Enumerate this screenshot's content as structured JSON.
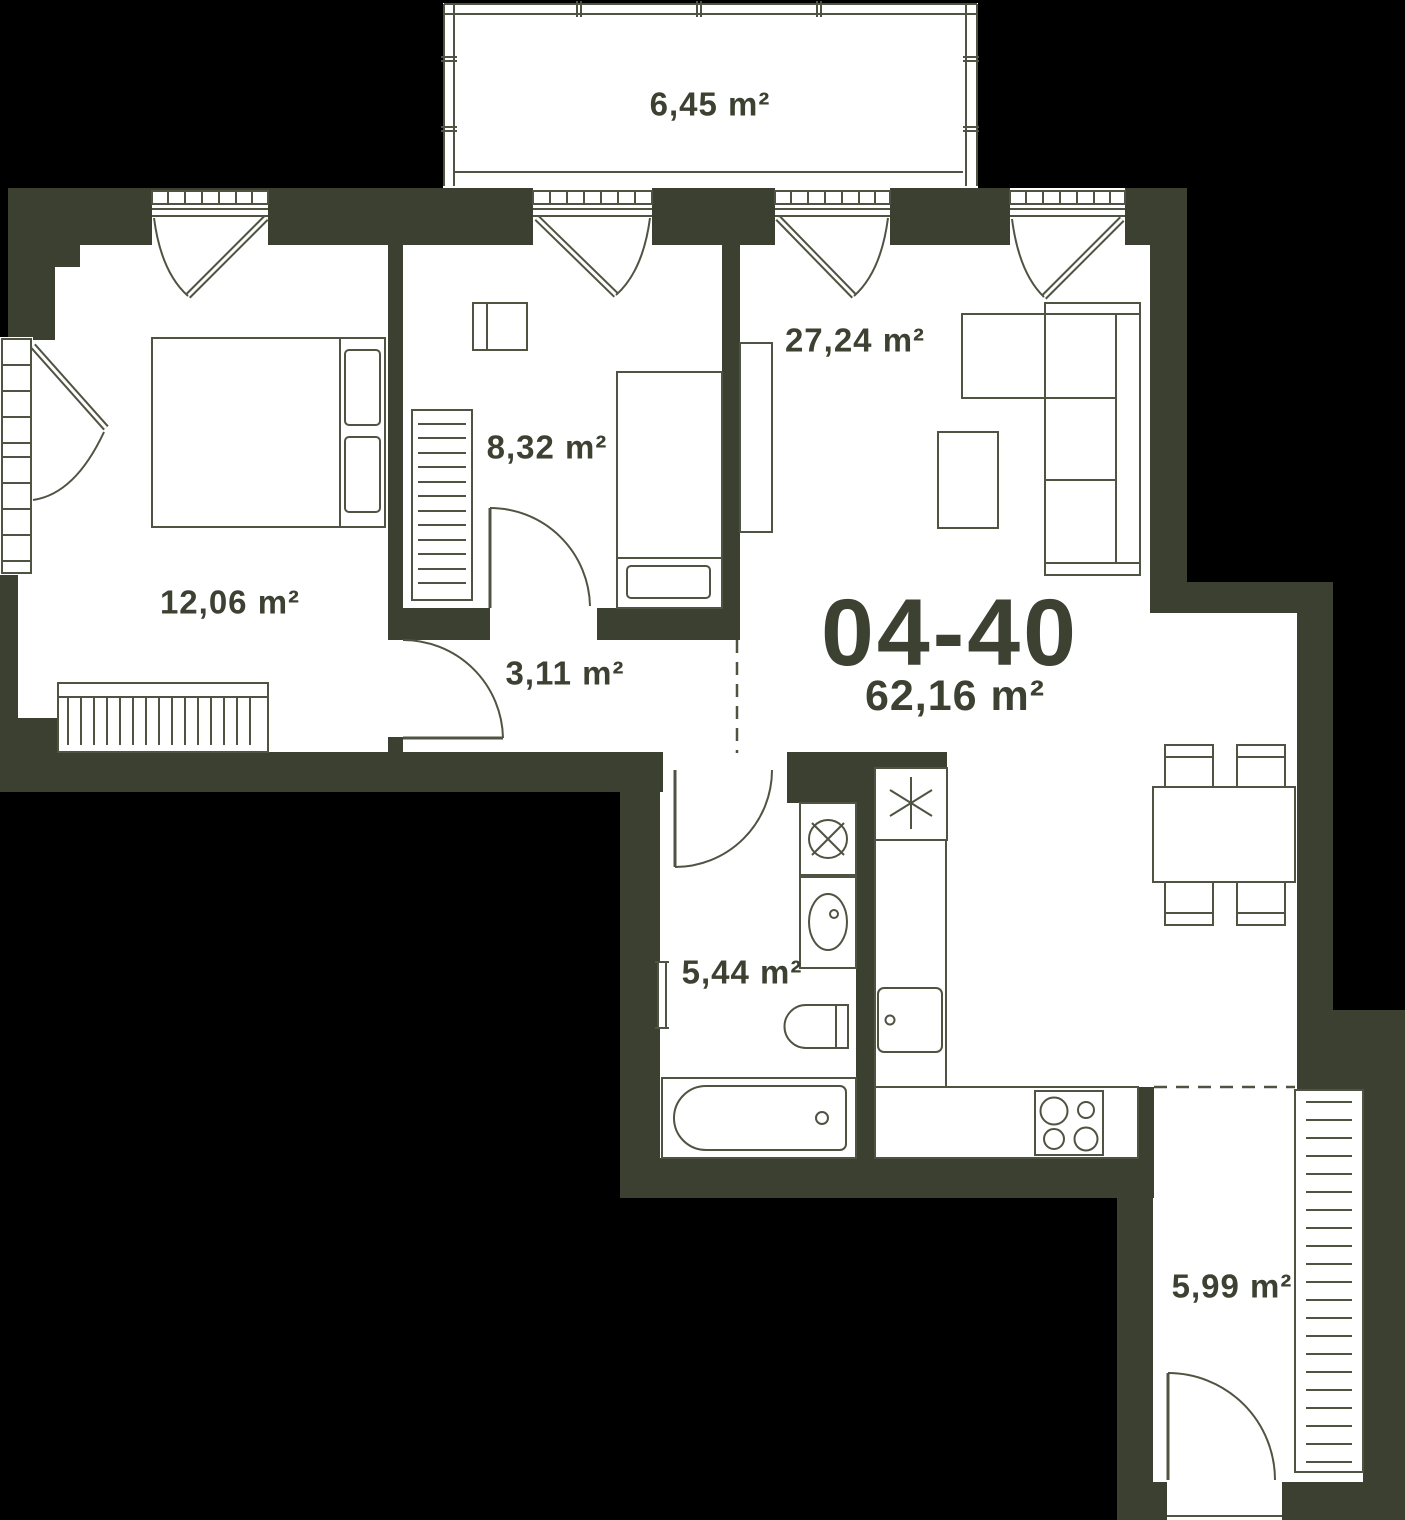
{
  "unit": {
    "number": "04-40",
    "total_area": "62,16 m²"
  },
  "rooms": [
    {
      "id": "balcony-top",
      "area": "6,45 m²"
    },
    {
      "id": "bedroom",
      "area": "12,06 m²"
    },
    {
      "id": "bedroom-small",
      "area": "8,32 m²"
    },
    {
      "id": "living-room",
      "area": "27,24 m²"
    },
    {
      "id": "hallway",
      "area": "3,11 m²"
    },
    {
      "id": "bathroom",
      "area": "5,44 m²"
    },
    {
      "id": "balcony-bottom",
      "area": "5,99 m²"
    }
  ],
  "colors": {
    "background": "#000000",
    "wall": "#3b4031",
    "floor": "#ffffff",
    "line": "#4f5442",
    "text": "#3c4132"
  }
}
